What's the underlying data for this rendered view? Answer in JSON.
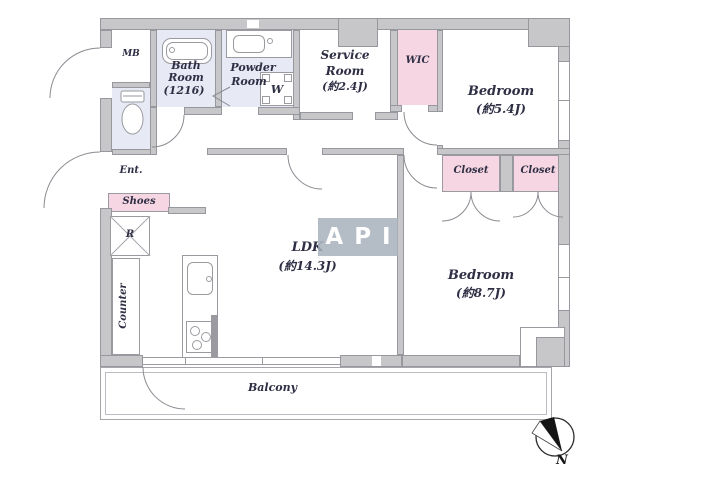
{
  "floorplan": {
    "watermark": {
      "text": "API"
    },
    "compass": {
      "north_label": "N"
    },
    "rooms": {
      "mb": {
        "label": "MB"
      },
      "bath": {
        "name_line1": "Bath",
        "name_line2": "Room",
        "size": "(1216)"
      },
      "powder": {
        "name_line1": "Powder",
        "name_line2": "Room"
      },
      "washing_machine": {
        "label": "W"
      },
      "service": {
        "name_line1": "Service",
        "name_line2": "Room",
        "size": "(約2.4J)"
      },
      "wic": {
        "label": "WIC"
      },
      "bedroom_54": {
        "name": "Bedroom",
        "size": "(約5.4J)"
      },
      "closet_left": {
        "label": "Closet"
      },
      "closet_right": {
        "label": "Closet"
      },
      "bedroom_87": {
        "name": "Bedroom",
        "size": "(約8.7J)"
      },
      "ldk": {
        "name": "LDK",
        "size": "(約14.3J)"
      },
      "entrance": {
        "label": "Ent."
      },
      "shoes": {
        "label": "Shoes"
      },
      "refrigerator": {
        "label": "R"
      },
      "counter": {
        "label": "Counter"
      },
      "balcony": {
        "label": "Balcony"
      }
    },
    "colors": {
      "wall_fill": "#c7c7ca",
      "wall_border": "#97979e",
      "wet_room_tint": "#e7eaf5",
      "storage_tint": "#f6d6e2",
      "text": "#2e2e44",
      "watermark_bg": "#a7b0bc",
      "watermark_text": "#ffffff"
    }
  }
}
